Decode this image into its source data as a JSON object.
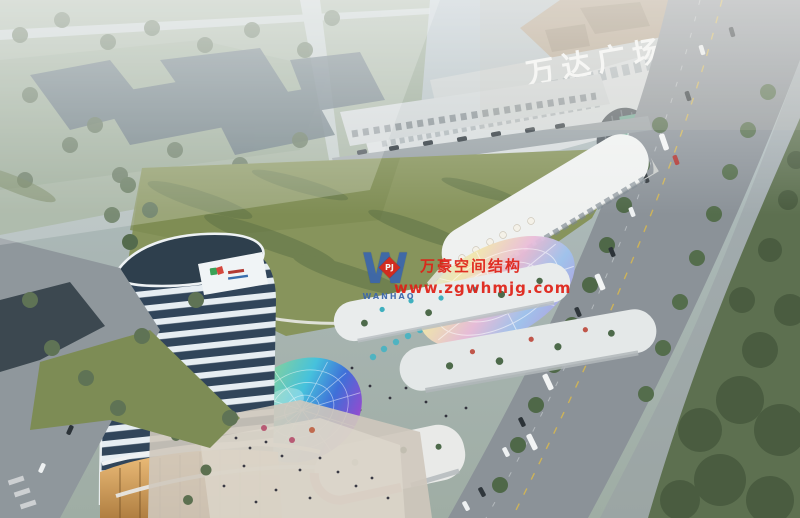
{
  "image": {
    "type": "aerial architectural rendering",
    "caption": "Dusk aerial rendering of a mixed-use complex: residential tower, curved retail street with iridescent canopies and rainbow glass dome, central lawn, and Wanda Plaza mall beside a tree-lined avenue"
  },
  "mall": {
    "sign": "万达广场"
  },
  "watermark": {
    "monogram": "W",
    "diamond_letters": "PJ",
    "brand": "WANHAO",
    "line1": "万豪空间结构",
    "line2": "www.zgwhmjg.com",
    "red": "#e01f15",
    "blue": "#3b66ad"
  },
  "palette": {
    "haze": "#b4c0c6",
    "lawn": "#87945c",
    "road": "#8b9298",
    "tower_band": "#e6edf2",
    "tower_glass": "#31455a",
    "podium_glow": "#e8b26a",
    "dome_rainbow": [
      "#f2d44d",
      "#7fcfa2",
      "#46c2dc",
      "#3f6fd8",
      "#8a4fd0",
      "#e05ac8"
    ]
  }
}
